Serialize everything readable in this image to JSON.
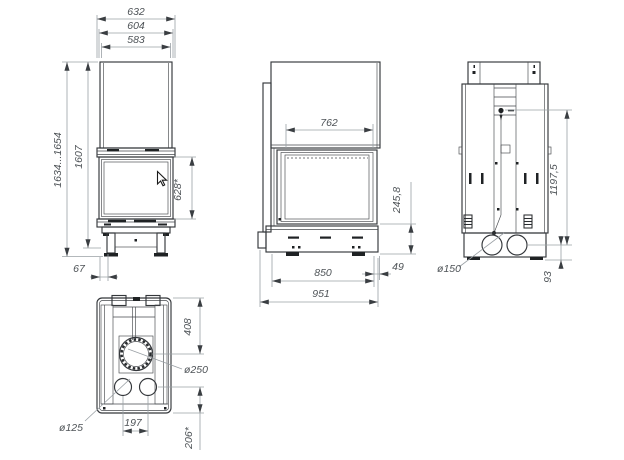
{
  "colors": {
    "background": "#ffffff",
    "object_line": "#34373b",
    "dimension_line": "#9aa0a5",
    "label_text": "#4e5357"
  },
  "views": {
    "front": {
      "dims": {
        "width_total": "632",
        "width_mid": "604",
        "width_glass": "583",
        "height_range": "1634...1654",
        "height_body": "1607",
        "glass_height": "628*",
        "leg_offset": "67"
      }
    },
    "side": {
      "dims": {
        "depth_top": "762",
        "base_height": "245,8",
        "depth_base": "850",
        "rear_gap": "49",
        "depth_total": "951"
      }
    },
    "rear": {
      "dims": {
        "flue_outlet_height": "1197,5",
        "duct_axis_height": "93",
        "duct_diameter": "ø150"
      }
    },
    "top": {
      "dims": {
        "flue_axis_offset": "408",
        "flue_diameter": "ø250",
        "duct_spacing": "197",
        "duct_axis_offset": "206*",
        "duct_diameter": "ø125"
      }
    }
  }
}
